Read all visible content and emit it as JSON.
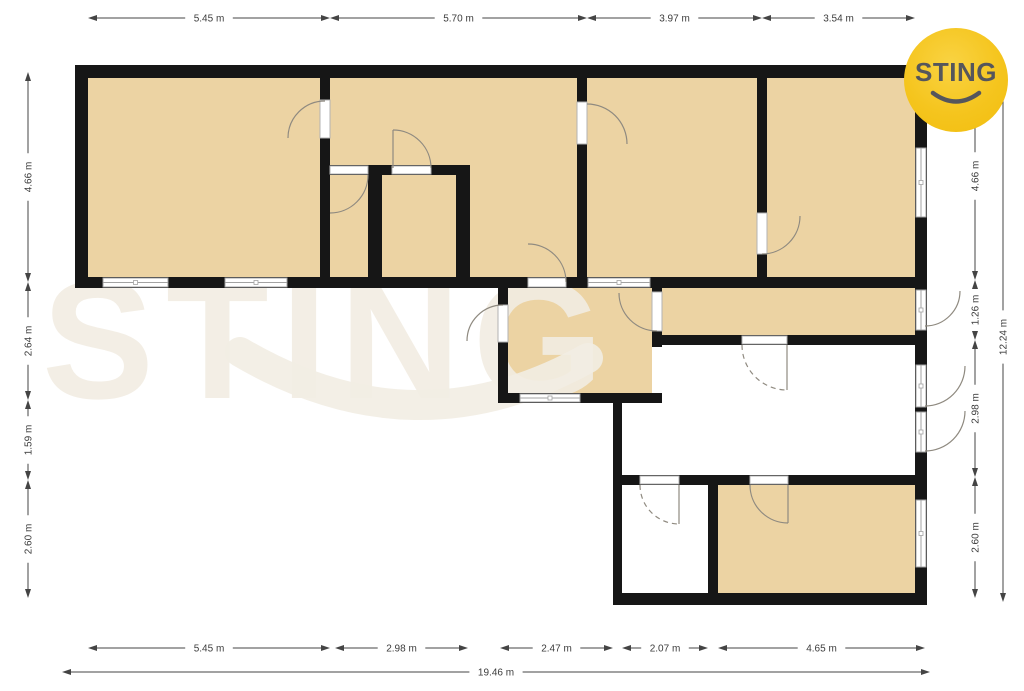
{
  "meta": {
    "width": 1024,
    "height": 691,
    "units": "m"
  },
  "logo": {
    "text": "STING",
    "bg_color": "#F5C51E",
    "text_color": "#55565C"
  },
  "watermark": {
    "text": "STING"
  },
  "colors": {
    "bg": "#FFFFFF",
    "room_fill": "#ECD3A3",
    "wall": "#161616",
    "window_frame": "#A3A3A3",
    "door_arc": "#8F8A80",
    "dim_line": "#444444",
    "dim_text": "#3C3C3C",
    "watermark": "#F2EDE3"
  },
  "dimension_groups": [
    {
      "name": "top",
      "orient": "h",
      "at": 18,
      "items": [
        {
          "label": "5.45 m",
          "from": 88,
          "to": 330
        },
        {
          "label": "5.70 m",
          "from": 330,
          "to": 587
        },
        {
          "label": "3.97 m",
          "from": 587,
          "to": 762
        },
        {
          "label": "3.54 m",
          "from": 762,
          "to": 915
        }
      ]
    },
    {
      "name": "left",
      "orient": "v",
      "at": 28,
      "items": [
        {
          "label": "4.66 m",
          "from": 72,
          "to": 282
        },
        {
          "label": "2.64 m",
          "from": 282,
          "to": 400
        },
        {
          "label": "1.59 m",
          "from": 400,
          "to": 480
        },
        {
          "label": "2.60 m",
          "from": 480,
          "to": 598
        }
      ]
    },
    {
      "name": "right-inner",
      "orient": "v",
      "at": 975,
      "items": [
        {
          "label": "4.66 m",
          "from": 72,
          "to": 280
        },
        {
          "label": "1.26 m",
          "from": 280,
          "to": 340
        },
        {
          "label": "2.98 m",
          "from": 340,
          "to": 477
        },
        {
          "label": "2.60 m",
          "from": 477,
          "to": 598
        }
      ]
    },
    {
      "name": "right-outer",
      "orient": "v",
      "at": 1003,
      "items": [
        {
          "label": "12.24 m",
          "from": 72,
          "to": 602
        }
      ]
    },
    {
      "name": "bottom-inner",
      "orient": "h",
      "at": 648,
      "items": [
        {
          "label": "5.45 m",
          "from": 88,
          "to": 330
        },
        {
          "label": "2.98 m",
          "from": 335,
          "to": 468
        },
        {
          "label": "2.47 m",
          "from": 500,
          "to": 613
        },
        {
          "label": "2.07 m",
          "from": 622,
          "to": 708
        },
        {
          "label": "4.65 m",
          "from": 718,
          "to": 925
        }
      ]
    },
    {
      "name": "bottom-outer",
      "orient": "h",
      "at": 672,
      "items": [
        {
          "label": "19.46 m",
          "from": 62,
          "to": 930
        }
      ]
    }
  ],
  "plan": {
    "rooms": [
      {
        "x": 88,
        "y": 78,
        "w": 232,
        "h": 199
      },
      {
        "x": 330,
        "y": 78,
        "w": 247,
        "h": 199
      },
      {
        "x": 587,
        "y": 78,
        "w": 170,
        "h": 199
      },
      {
        "x": 767,
        "y": 78,
        "w": 148,
        "h": 199
      },
      {
        "x": 508,
        "y": 288,
        "w": 144,
        "h": 105
      },
      {
        "x": 662,
        "y": 288,
        "w": 253,
        "h": 47
      },
      {
        "x": 718,
        "y": 485,
        "w": 197,
        "h": 108
      }
    ],
    "walls": [
      {
        "x": 75,
        "y": 65,
        "w": 852,
        "h": 13
      },
      {
        "x": 75,
        "y": 65,
        "w": 13,
        "h": 223
      },
      {
        "x": 75,
        "y": 277,
        "w": 852,
        "h": 11
      },
      {
        "x": 915,
        "y": 65,
        "w": 12,
        "h": 540
      },
      {
        "x": 320,
        "y": 65,
        "w": 10,
        "h": 223
      },
      {
        "x": 577,
        "y": 65,
        "w": 10,
        "h": 223
      },
      {
        "x": 757,
        "y": 65,
        "w": 10,
        "h": 223
      },
      {
        "x": 320,
        "y": 165,
        "w": 150,
        "h": 10
      },
      {
        "x": 368,
        "y": 165,
        "w": 14,
        "h": 123
      },
      {
        "x": 456,
        "y": 165,
        "w": 14,
        "h": 123
      },
      {
        "x": 498,
        "y": 277,
        "w": 10,
        "h": 126
      },
      {
        "x": 498,
        "y": 393,
        "w": 164,
        "h": 10
      },
      {
        "x": 652,
        "y": 288,
        "w": 10,
        "h": 59
      },
      {
        "x": 652,
        "y": 335,
        "w": 265,
        "h": 10
      },
      {
        "x": 613,
        "y": 403,
        "w": 9,
        "h": 202
      },
      {
        "x": 613,
        "y": 475,
        "w": 304,
        "h": 10
      },
      {
        "x": 708,
        "y": 475,
        "w": 10,
        "h": 130
      },
      {
        "x": 613,
        "y": 593,
        "w": 314,
        "h": 12
      }
    ],
    "windows": [
      {
        "x": 103,
        "y": 278,
        "w": 65,
        "h": 9,
        "orient": "h"
      },
      {
        "x": 225,
        "y": 278,
        "w": 62,
        "h": 9,
        "orient": "h"
      },
      {
        "x": 588,
        "y": 278,
        "w": 62,
        "h": 9,
        "orient": "h"
      },
      {
        "x": 520,
        "y": 394,
        "w": 60,
        "h": 8,
        "orient": "h"
      },
      {
        "x": 916,
        "y": 148,
        "w": 10,
        "h": 69,
        "orient": "v"
      },
      {
        "x": 916,
        "y": 500,
        "w": 10,
        "h": 67,
        "orient": "v"
      },
      {
        "x": 916,
        "y": 290,
        "w": 10,
        "h": 40,
        "orient": "v"
      },
      {
        "x": 916,
        "y": 365,
        "w": 10,
        "h": 42,
        "orient": "v"
      },
      {
        "x": 916,
        "y": 412,
        "w": 10,
        "h": 40,
        "orient": "v"
      }
    ],
    "door_leaves": [
      {
        "x": 320,
        "y": 100,
        "w": 10,
        "h": 38
      },
      {
        "x": 577,
        "y": 102,
        "w": 10,
        "h": 42
      },
      {
        "x": 757,
        "y": 213,
        "w": 10,
        "h": 41
      },
      {
        "x": 330,
        "y": 166,
        "w": 38,
        "h": 8
      },
      {
        "x": 392,
        "y": 166,
        "w": 39,
        "h": 8
      },
      {
        "x": 528,
        "y": 278,
        "w": 38,
        "h": 9
      },
      {
        "x": 498,
        "y": 305,
        "w": 10,
        "h": 37
      },
      {
        "x": 652,
        "y": 292,
        "w": 10,
        "h": 39
      },
      {
        "x": 742,
        "y": 336,
        "w": 45,
        "h": 8
      },
      {
        "x": 640,
        "y": 476,
        "w": 39,
        "h": 8
      },
      {
        "x": 750,
        "y": 476,
        "w": 38,
        "h": 8
      }
    ],
    "door_arcs": [
      {
        "d": "M 325 101 A 37 37 0 0 0 288 138",
        "dashed": false
      },
      {
        "d": "M 368 175 A 38 38 0 0 1 330 213",
        "dashed": false
      },
      {
        "d": "M 393 130 A 38 38 0 0 1 431 168",
        "dashed": false
      },
      {
        "d": "M 393 130 L 393 168",
        "dashed": false
      },
      {
        "d": "M 587 104 A 40 40 0 0 1 627 144",
        "dashed": false
      },
      {
        "d": "M 528 244 A 38 38 0 0 1 566 282",
        "dashed": false
      },
      {
        "d": "M 503 305 A 36 36 0 0 0 467 341",
        "dashed": false
      },
      {
        "d": "M 657 331 A 38 38 0 0 1 619 293",
        "dashed": false
      },
      {
        "d": "M 800 216 A 38 38 0 0 1 762 254",
        "dashed": false
      },
      {
        "d": "M 742 345 A 45 45 0 0 0 787 390",
        "dashed": true
      },
      {
        "d": "M 787 345 L 787 390",
        "dashed": false
      },
      {
        "d": "M 640 485 A 39 39 0 0 0 679 524",
        "dashed": true
      },
      {
        "d": "M 679 485 L 679 524",
        "dashed": false
      },
      {
        "d": "M 750 485 A 38 38 0 0 0 788 523",
        "dashed": false
      },
      {
        "d": "M 788 485 L 788 523",
        "dashed": false
      },
      {
        "d": "M 960 291 A 35 35 0 0 1 925 326",
        "dashed": false
      },
      {
        "d": "M 965 366 A 40 40 0 0 1 925 406",
        "dashed": false
      },
      {
        "d": "M 965 411 A 40 40 0 0 1 925 451",
        "dashed": false
      }
    ]
  }
}
